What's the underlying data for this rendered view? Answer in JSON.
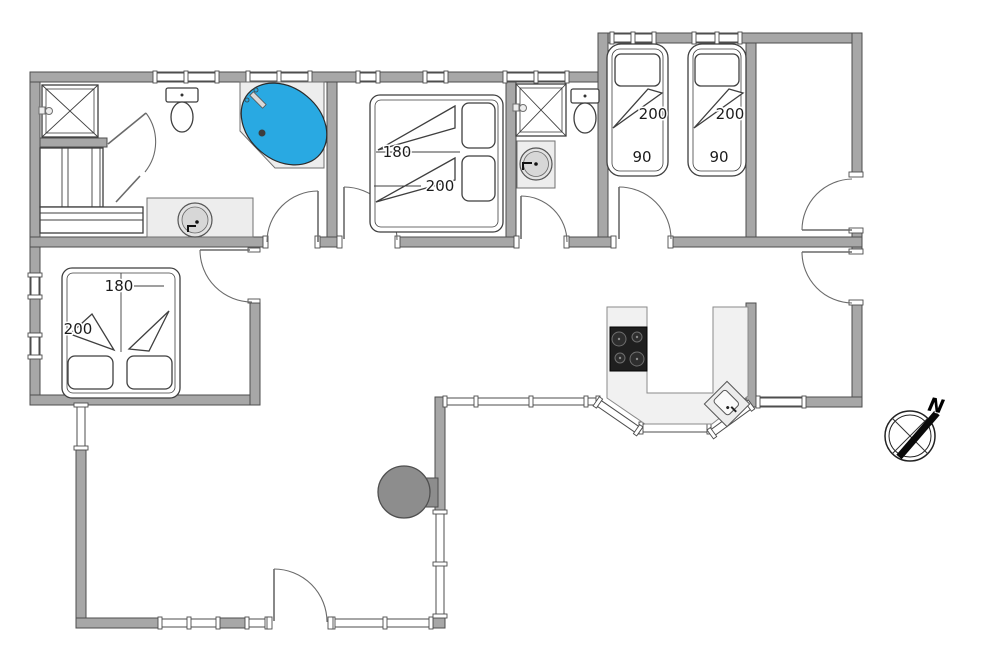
{
  "type": "holiday-home-floor-plan",
  "colors": {
    "wall": "#a7a7a7",
    "tub_water": "#29a9e2",
    "cooktop": "#1f1f1f",
    "wood_stove": "#8d8d8d",
    "counter": "#f1f1f1"
  },
  "rooms": {
    "bedroom_middle": {
      "bed_width": "180",
      "bed_length": "200"
    },
    "bedroom_southwest": {
      "bed_width": "180",
      "bed_length": "200"
    },
    "bedroom_twin": {
      "bed1": {
        "length": "200",
        "width": "90"
      },
      "bed2": {
        "length": "200",
        "width": "90"
      }
    }
  },
  "compass": {
    "north_label": "N"
  }
}
